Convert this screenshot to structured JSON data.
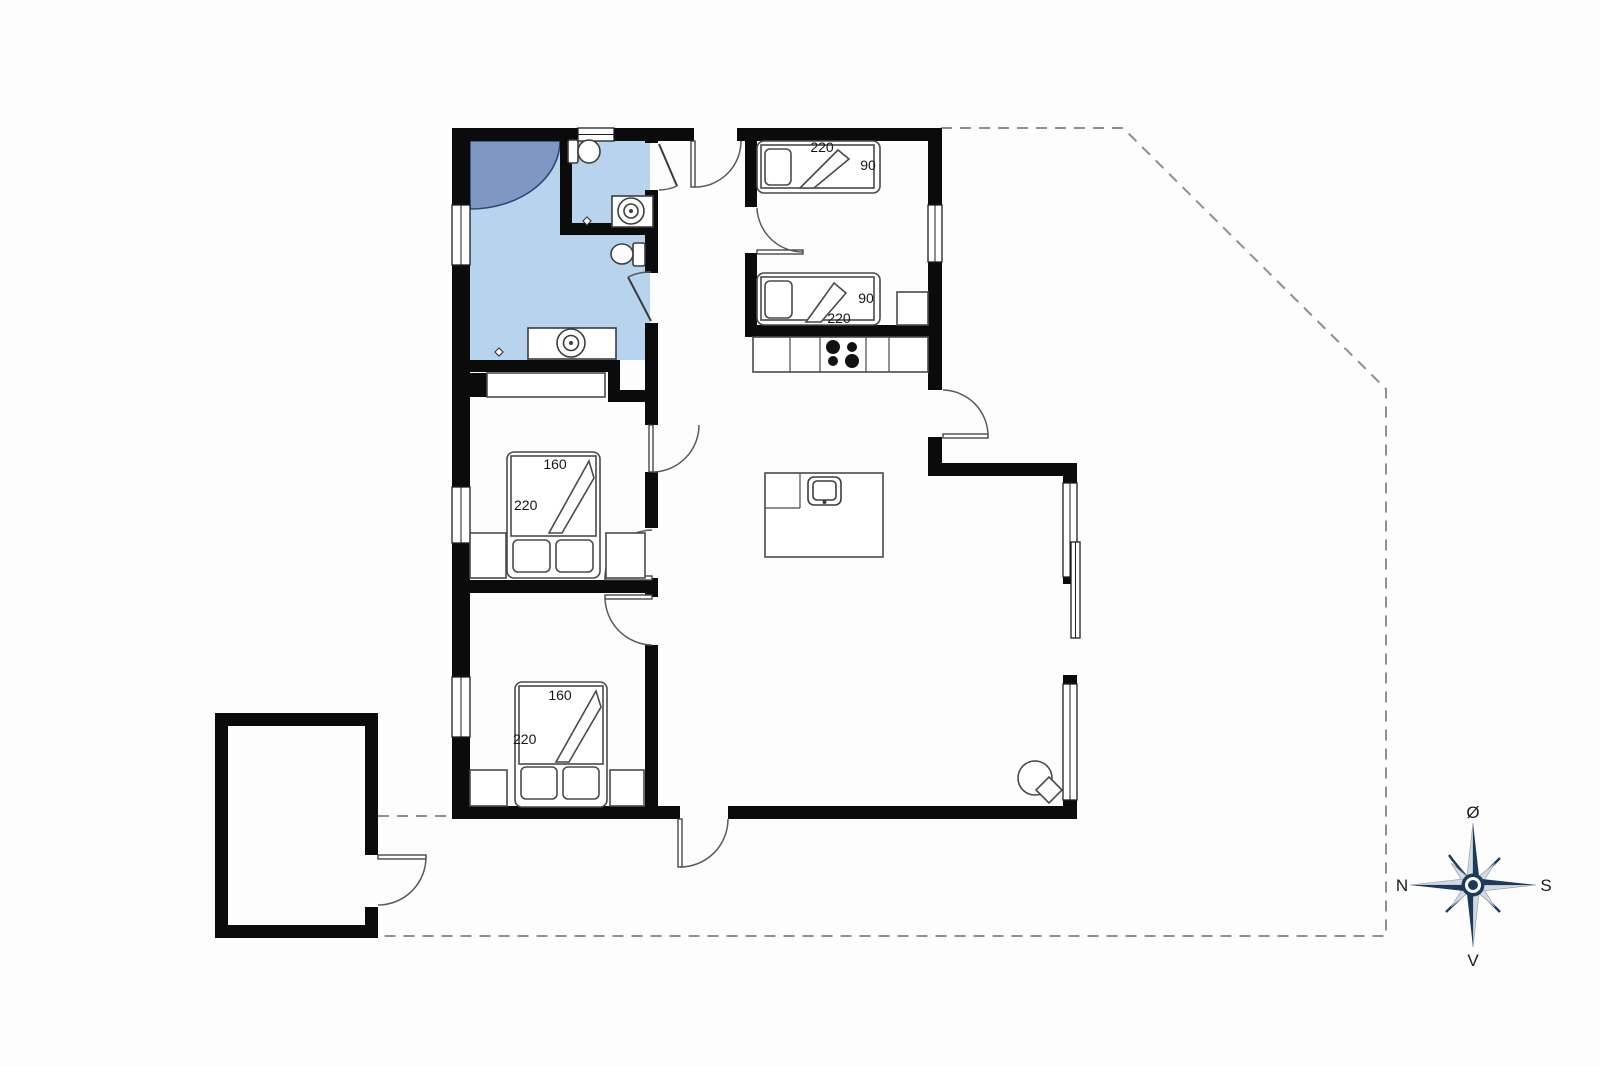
{
  "plan": {
    "beds": {
      "single_top": {
        "length": "220",
        "width": "90"
      },
      "single_bottom": {
        "length": "220",
        "width": "90"
      },
      "double_upper": {
        "width": "160",
        "length": "220"
      },
      "double_lower": {
        "width": "160",
        "length": "220"
      }
    },
    "compass": {
      "east": "Ø",
      "south": "S",
      "west": "V",
      "north": "N"
    },
    "colors": {
      "wall": "#0b0b0b",
      "bathroom_floor": "#b7d3ee",
      "shower": "#8097c3",
      "shower_outline": "#2b4a73",
      "compass_primary": "#1c3a5c",
      "compass_secondary": "#d3d9e0",
      "dashed_line": "#8f8f8f",
      "background": "#fdfdfd"
    }
  }
}
